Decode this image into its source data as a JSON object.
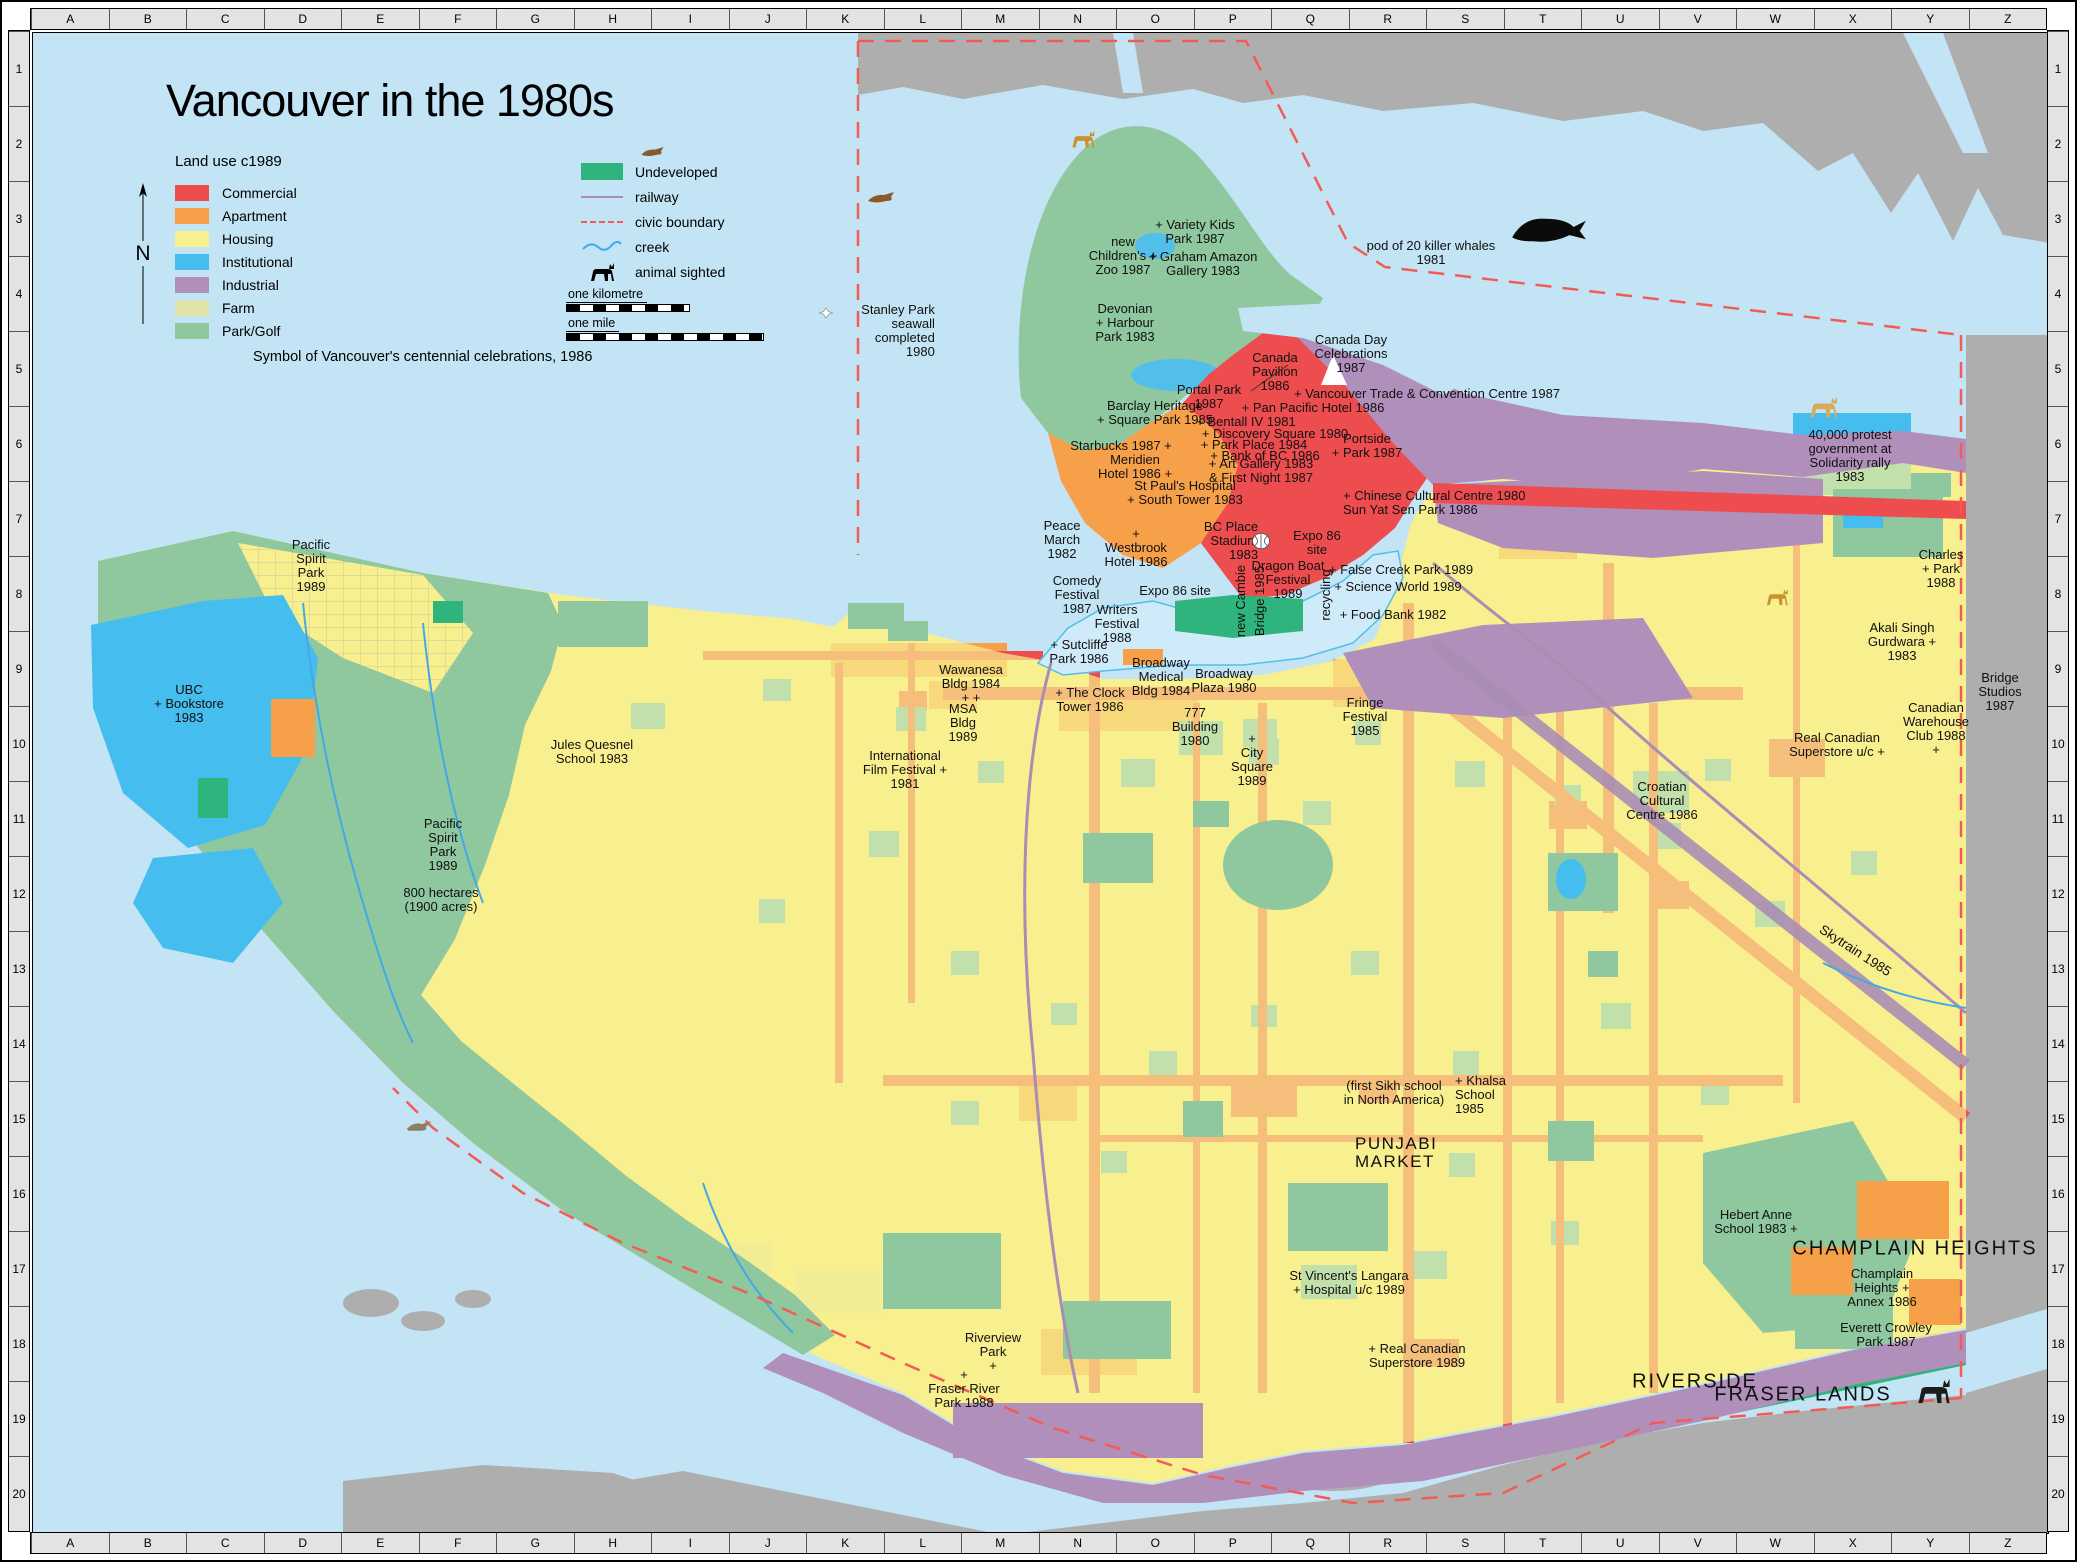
{
  "title": "Vancouver in the 1980s",
  "north_letter": "N",
  "legend": {
    "heading": "Land use  c1989",
    "caption": "Symbol of Vancouver's centennial celebrations, 1986",
    "landuse": [
      {
        "label": "Commercial",
        "color": "#ee4d4f"
      },
      {
        "label": "Apartment",
        "color": "#f6a14a"
      },
      {
        "label": "Housing",
        "color": "#f8ef8e"
      },
      {
        "label": "Institutional",
        "color": "#45bdee"
      },
      {
        "label": "Industrial",
        "color": "#b18fbb"
      },
      {
        "label": "Farm",
        "color": "#dfe4a8"
      },
      {
        "label": "Park/Golf",
        "color": "#8fc79f"
      }
    ],
    "symbols": [
      {
        "label": "Undeveloped",
        "type": "undeveloped",
        "color": "#2eb47c"
      },
      {
        "label": "railway",
        "type": "railway",
        "color": "#a98db4"
      },
      {
        "label": "civic boundary",
        "type": "boundary",
        "color": "#f25c55"
      },
      {
        "label": "creek",
        "type": "creek",
        "color": "#44a8e6",
        "shape": "wave"
      },
      {
        "label": "animal sighted",
        "type": "animal",
        "color": "#c8922e",
        "shape": "quadruped"
      }
    ]
  },
  "scale": {
    "km_label": "one kilometre",
    "mile_label": "one mile"
  },
  "grid": {
    "columns": [
      "A",
      "B",
      "C",
      "D",
      "E",
      "F",
      "G",
      "H",
      "I",
      "J",
      "K",
      "L",
      "M",
      "N",
      "O",
      "P",
      "Q",
      "R",
      "S",
      "T",
      "U",
      "V",
      "W",
      "X",
      "Y",
      "Z"
    ],
    "rows": [
      "1",
      "2",
      "3",
      "4",
      "5",
      "6",
      "7",
      "8",
      "9",
      "10",
      "11",
      "12",
      "13",
      "14",
      "15",
      "16",
      "17",
      "18",
      "19",
      "20"
    ]
  },
  "labels": [
    {
      "t": "Stanley Park\nseawall\ncompleted\n1980",
      "x": 895,
      "y": 328,
      "cls": "ta-r"
    },
    {
      "t": "new\nChildren's +\nZoo 1987",
      "x": 1120,
      "y": 253
    },
    {
      "t": "+ Variety Kids\nPark 1987",
      "x": 1192,
      "y": 229
    },
    {
      "t": "+ Graham Amazon\nGallery 1983",
      "x": 1200,
      "y": 261
    },
    {
      "t": "Devonian\n+ Harbour\nPark 1983",
      "x": 1122,
      "y": 320
    },
    {
      "t": "pod of 20 killer whales\n1981",
      "x": 1428,
      "y": 250
    },
    {
      "t": "Portal Park\n1987",
      "x": 1206,
      "y": 394
    },
    {
      "t": "Canada\nPavilion\n1986",
      "x": 1272,
      "y": 369
    },
    {
      "t": "Canada Day\nCelebrations\n1987",
      "x": 1348,
      "y": 351
    },
    {
      "t": "+ Vancouver Trade & Convention Centre 1987",
      "x": 1424,
      "y": 391,
      "cls": "nowrap"
    },
    {
      "t": "+ Pan Pacific Hotel 1986",
      "x": 1310,
      "y": 405,
      "cls": "nowrap"
    },
    {
      "t": "Barclay Heritage\n+ Square Park 1985",
      "x": 1152,
      "y": 410
    },
    {
      "t": "+ Bentall IV 1981",
      "x": 1243,
      "y": 419,
      "cls": "nowrap"
    },
    {
      "t": "+ Discovery Square 1980",
      "x": 1272,
      "y": 431,
      "cls": "nowrap"
    },
    {
      "t": "+ Park Place 1984",
      "x": 1251,
      "y": 442,
      "cls": "nowrap"
    },
    {
      "t": "+ Bank of BC 1986",
      "x": 1262,
      "y": 453,
      "cls": "nowrap"
    },
    {
      "t": "+ Art Gallery 1983\n& First Night 1987",
      "x": 1258,
      "y": 468
    },
    {
      "t": "Starbucks 1987 +",
      "x": 1118,
      "y": 443,
      "cls": "nowrap"
    },
    {
      "t": "Meridien\nHotel 1986 +",
      "x": 1132,
      "y": 464
    },
    {
      "t": "Portside\n+ Park 1987",
      "x": 1364,
      "y": 443
    },
    {
      "t": "St Paul's Hospital\n+ South Tower 1983",
      "x": 1182,
      "y": 490
    },
    {
      "t": "+ Chinese Cultural Centre 1980\nSun Yat Sen Park 1986",
      "x": 1340,
      "y": 500,
      "cls": "ta-l"
    },
    {
      "t": "Peace\nMarch\n1982",
      "x": 1059,
      "y": 537
    },
    {
      "t": "+\nWestbrook\nHotel 1986",
      "x": 1133,
      "y": 545
    },
    {
      "t": "BC Place\nStadium\n1983",
      "x": 1228,
      "y": 538,
      "cls": "ta-r"
    },
    {
      "t": "Expo 86\nsite",
      "x": 1314,
      "y": 540
    },
    {
      "t": "Expo 86 site",
      "x": 1172,
      "y": 588,
      "cls": "nowrap"
    },
    {
      "t": "Dragon Boat\nFestival\n1989",
      "x": 1285,
      "y": 577
    },
    {
      "t": "+ False Creek Park 1989",
      "x": 1398,
      "y": 567,
      "cls": "nowrap"
    },
    {
      "t": "+ Science World 1989",
      "x": 1395,
      "y": 584,
      "cls": "nowrap"
    },
    {
      "t": "recycling",
      "x": 1323,
      "y": 592,
      "cls": "rt"
    },
    {
      "t": "+ Food Bank 1982",
      "x": 1390,
      "y": 612,
      "cls": "nowrap"
    },
    {
      "t": "Comedy\nFestival\n1987",
      "x": 1074,
      "y": 592
    },
    {
      "t": "Writers\nFestival\n1988",
      "x": 1114,
      "y": 621
    },
    {
      "t": "new Cambie",
      "x": 1238,
      "y": 598,
      "cls": "rt"
    },
    {
      "t": "Bridge 1985",
      "x": 1257,
      "y": 598,
      "cls": "rt"
    },
    {
      "t": "+ Sutcliffe\nPark 1986",
      "x": 1076,
      "y": 649
    },
    {
      "t": "Broadway\nMedical\nBldg 1984",
      "x": 1158,
      "y": 674
    },
    {
      "t": "Broadway\nPlaza 1980",
      "x": 1221,
      "y": 678
    },
    {
      "t": "Fringe\nFestival\n1985",
      "x": 1362,
      "y": 714
    },
    {
      "t": "Wawanesa\nBldg 1984\n+ +",
      "x": 968,
      "y": 681
    },
    {
      "t": "MSA\nBldg\n1989",
      "x": 960,
      "y": 720
    },
    {
      "t": "+ The Clock\nTower 1986",
      "x": 1087,
      "y": 697
    },
    {
      "t": "777\nBuilding\n1980",
      "x": 1192,
      "y": 724
    },
    {
      "t": "+\nCity\nSquare\n1989",
      "x": 1249,
      "y": 757
    },
    {
      "t": "International\nFilm Festival +\n1981",
      "x": 902,
      "y": 767
    },
    {
      "t": "Jules Quesnel\nSchool 1983",
      "x": 589,
      "y": 749
    },
    {
      "t": "Pacific\nSpirit\nPark\n1989",
      "x": 308,
      "y": 563
    },
    {
      "t": "UBC\n+ Bookstore\n1983",
      "x": 186,
      "y": 701
    },
    {
      "t": "Pacific\nSpirit\nPark\n1989",
      "x": 440,
      "y": 842
    },
    {
      "t": "800 hectares\n(1900 acres)",
      "x": 438,
      "y": 897
    },
    {
      "t": "40,000 protest\ngovernment at\nSolidarity rally\n1983",
      "x": 1847,
      "y": 453
    },
    {
      "t": "Charles\n+ Park\n1988",
      "x": 1938,
      "y": 566
    },
    {
      "t": "Akali Singh\nGurdwara +\n1983",
      "x": 1899,
      "y": 639
    },
    {
      "t": "Bridge\nStudios\n1987",
      "x": 1997,
      "y": 689
    },
    {
      "t": "Canadian\nWarehouse\nClub 1988\n+",
      "x": 1933,
      "y": 726
    },
    {
      "t": "Real Canadian\nSuperstore u/c +",
      "x": 1834,
      "y": 742
    },
    {
      "t": "Croatian\nCultural\nCentre 1986",
      "x": 1659,
      "y": 798
    },
    {
      "t": "Skytrain 1985",
      "x": 1852,
      "y": 948,
      "cls": "sky"
    },
    {
      "t": "(first Sikh school\nin North America)",
      "x": 1391,
      "y": 1090
    },
    {
      "t": "+ Khalsa\nSchool\n1985",
      "x": 1452,
      "y": 1092,
      "cls": "ta-l"
    },
    {
      "t": "PUNJABI\nMARKET",
      "x": 1352,
      "y": 1150,
      "cls": "region ta-l"
    },
    {
      "t": "Hebert Anne\nSchool 1983 +",
      "x": 1753,
      "y": 1219
    },
    {
      "t": "CHAMPLAIN\nHEIGHTS",
      "x": 1912,
      "y": 1246,
      "cls": "region-xl"
    },
    {
      "t": "Champlain\nHeights +\nAnnex 1986",
      "x": 1879,
      "y": 1285
    },
    {
      "t": "Everett Crowley\nPark 1987",
      "x": 1883,
      "y": 1332
    },
    {
      "t": "St Vincent's Langara\n+ Hospital u/c 1989",
      "x": 1346,
      "y": 1280
    },
    {
      "t": "+ Real Canadian\nSuperstore 1989",
      "x": 1414,
      "y": 1353
    },
    {
      "t": "Riverview\nPark\n+",
      "x": 990,
      "y": 1349
    },
    {
      "t": "+\nFraser River\nPark 1988",
      "x": 961,
      "y": 1386
    },
    {
      "t": "RIVERSIDE",
      "x": 1692,
      "y": 1379,
      "cls": "region-xl"
    },
    {
      "t": "FRASER LANDS",
      "x": 1800,
      "y": 1392,
      "cls": "region-xl"
    }
  ],
  "icons": [
    {
      "name": "fish-icon",
      "shape": "seal",
      "color": "#8a5a2b",
      "x": 652,
      "y": 150,
      "w": 34
    },
    {
      "name": "seal-icon",
      "shape": "seal",
      "color": "#8a5a2b",
      "x": 881,
      "y": 196,
      "w": 40
    },
    {
      "name": "deer-icon",
      "shape": "quadruped",
      "color": "#c8922e",
      "x": 1079,
      "y": 136,
      "w": 38
    },
    {
      "name": "orca-icon",
      "shape": "whale",
      "color": "#0b0b0b",
      "x": 1546,
      "y": 226,
      "w": 82
    },
    {
      "name": "cougar-icon",
      "shape": "quadruped",
      "color": "#d8a95e",
      "x": 1819,
      "y": 404,
      "w": 46
    },
    {
      "name": "deer-icon",
      "shape": "quadruped",
      "color": "#c8922e",
      "x": 1773,
      "y": 594,
      "w": 36
    },
    {
      "name": "heron-icon",
      "shape": "bird",
      "color": "#8a7f63",
      "x": 419,
      "y": 1124,
      "w": 38
    },
    {
      "name": "bear-icon",
      "shape": "quadruped",
      "color": "#1c1c1c",
      "x": 1929,
      "y": 1388,
      "w": 54
    },
    {
      "name": "stadium-icon",
      "shape": "stadium",
      "color": "#ffffff",
      "x": 1258,
      "y": 538,
      "w": 34
    },
    {
      "name": "centennial-icon",
      "shape": "diamond",
      "color": "#ffffff",
      "x": 823,
      "y": 310,
      "w": 26
    }
  ]
}
